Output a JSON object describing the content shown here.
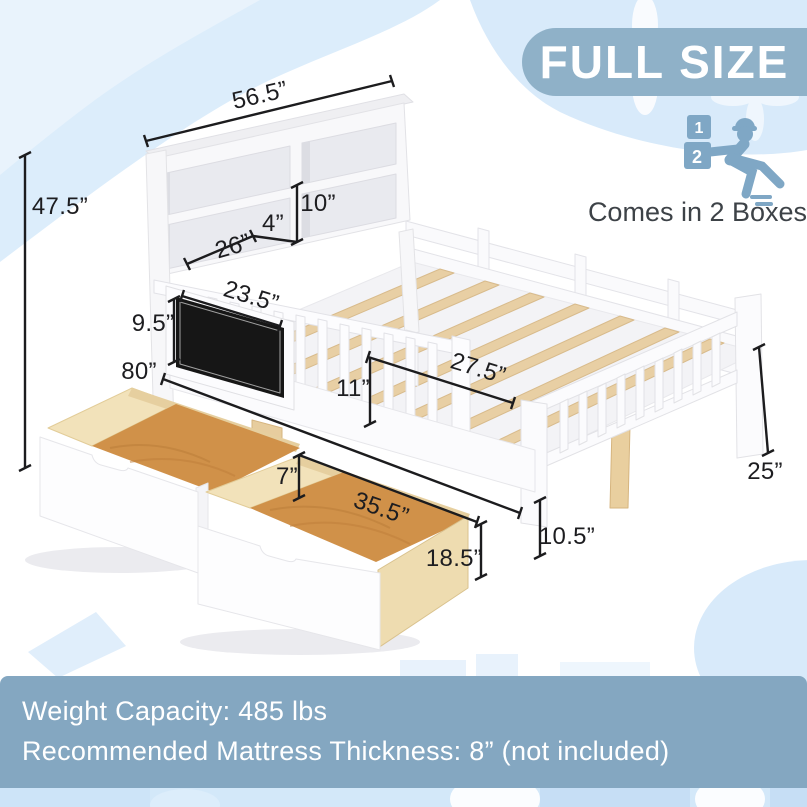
{
  "badge": {
    "label": "FULL SIZE",
    "bg": "#8fb1c8"
  },
  "delivery": {
    "caption": "Comes in 2 Boxes",
    "box_labels": [
      "1",
      "2"
    ],
    "icon": "delivery-worker-boxes-icon",
    "icon_color": "#7fa7c5"
  },
  "dimensions": {
    "headboard_width": "56.5”",
    "overall_height": "47.5”",
    "cubby_height": "10”",
    "shelf_lip": "4”",
    "shelf_width": "26”",
    "chalkboard_width": "23.5”",
    "chalkboard_height": "9.5”",
    "bed_length": "80”",
    "bed_inner_width": "27.5”",
    "guardrail_height": "11”",
    "drawer_height": "7”",
    "drawer_width": "35.5”",
    "drawer_depth": "18.5”",
    "underbed_clearance": "10.5”",
    "footboard_height": "25”"
  },
  "footer": {
    "weight_capacity": "Weight Capacity: 485 lbs",
    "mattress_note": "Recommended Mattress Thickness: 8” (not included)"
  },
  "colors": {
    "accent": "#8fb1c8",
    "footer_bg": "#84a7c1",
    "background_blue": "#d8eafa",
    "wood_floor": "#d09149",
    "wood_light": "#f2e2ba",
    "slat_wood": "#e8cfa4",
    "chalkboard": "#161616",
    "dimension_line": "#1c1c1e"
  }
}
